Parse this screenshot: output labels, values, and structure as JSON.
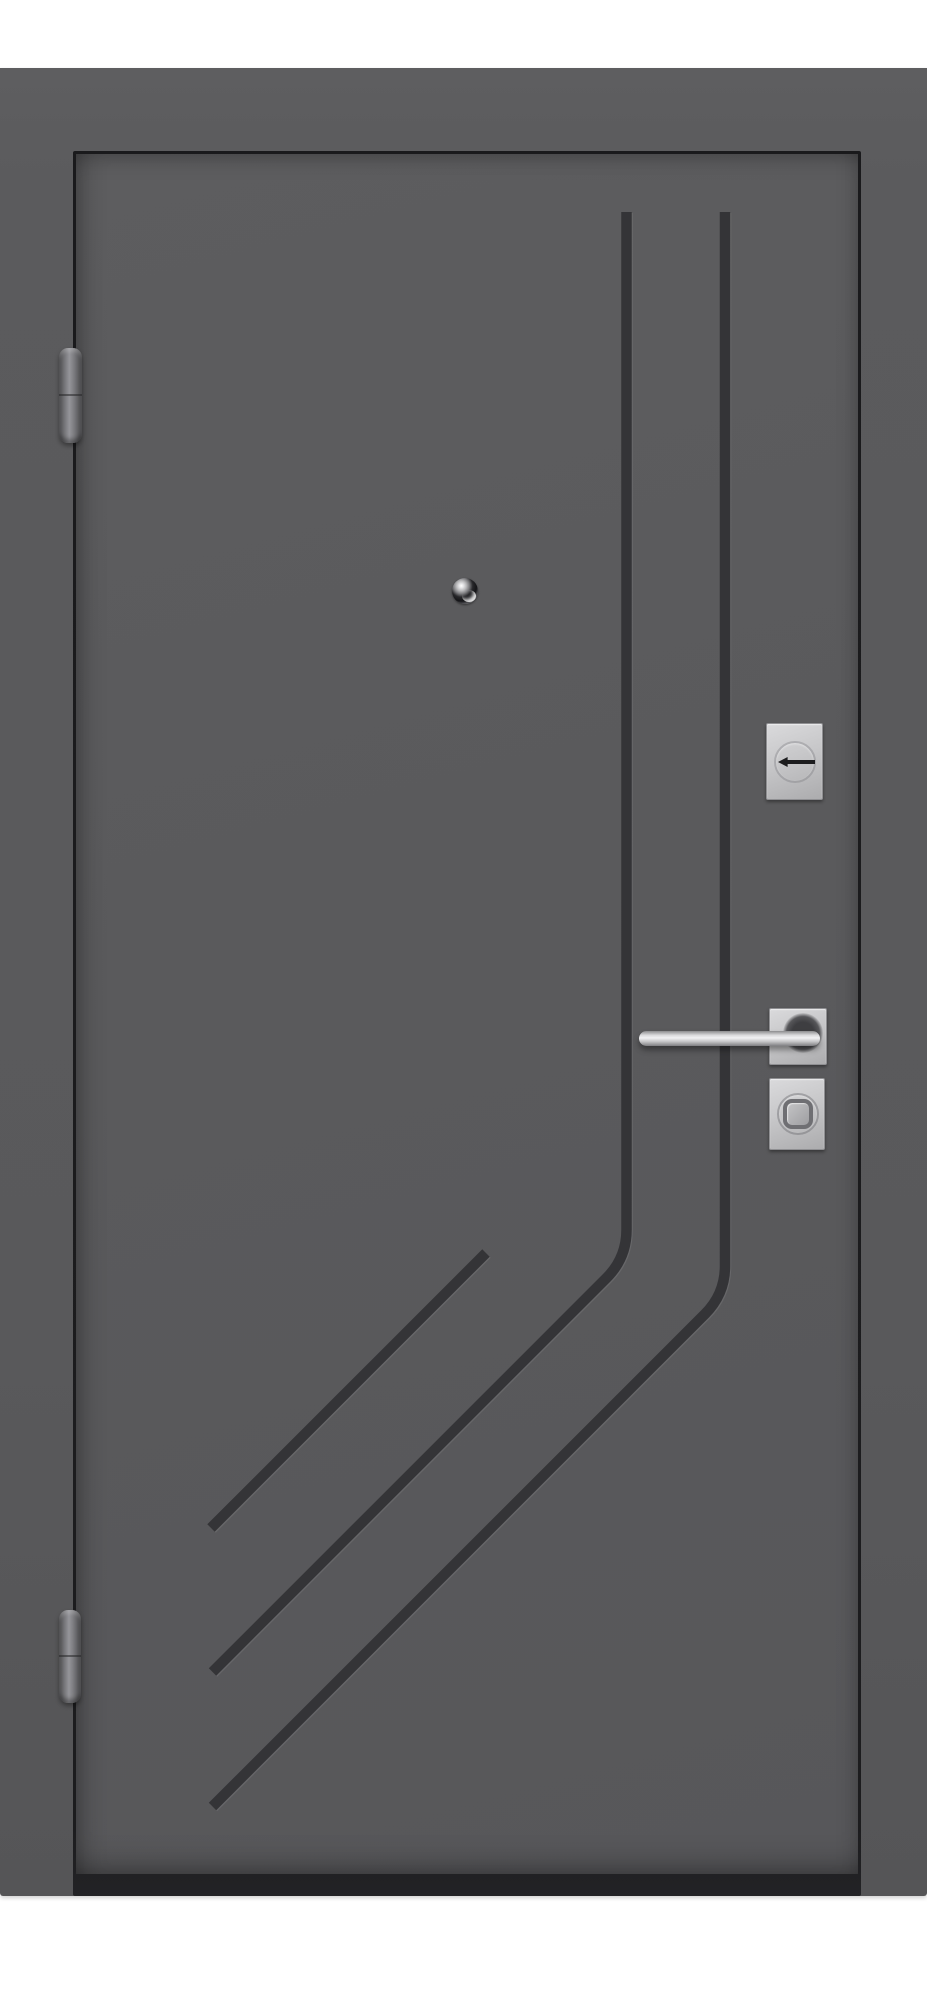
{
  "image": {
    "subject": "Gray metal entrance door, closed, front view on white background, with two vertical grooves bending into diagonal grooves at the lower left and satin-chrome hardware"
  },
  "colors": {
    "background": "#ffffff",
    "frame": "#5b5b5d",
    "leaf": "#5a5a5c",
    "seam": "#1a1a1c",
    "groove": "#343437",
    "threshold": "#232326",
    "silver": "#c7c7c9",
    "silver_dark": "#8f8f92",
    "hinge": "#7e7e81",
    "keyhole": "#1d1d1f"
  },
  "parts": {
    "photo": "Entrance door product photo",
    "frame": "Door frame",
    "leaf": "Door leaf",
    "grooves": "Decorative milled grooves",
    "hinge_top": "Top barrel hinge",
    "hinge_bottom": "Bottom barrel hinge",
    "peephole": "Chrome peephole viewer",
    "cylinder": "Square cylinder escutcheon with horizontal keyhole",
    "rosette": "Square handle rosette",
    "handle": "Horizontal satin-chrome lever handle",
    "thumbturn": "Square escutcheon with round thumb-turn knob"
  }
}
